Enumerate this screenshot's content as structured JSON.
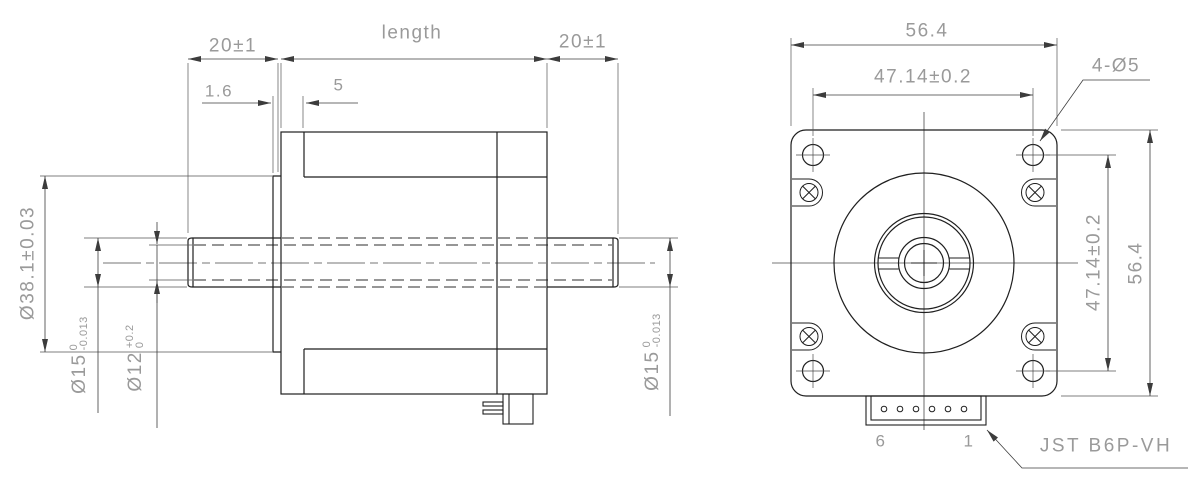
{
  "side_view": {
    "front_shaft_len": "20±1",
    "body_len": "length",
    "rear_shaft_len": "20±1",
    "boss_depth": "1.6",
    "front_section": "5",
    "boss_dia": "Ø38.1±0.03",
    "shaft_dia_left": {
      "main": "Ø15",
      "tol_top": "0",
      "tol_bot": "-0.013"
    },
    "bore_dia": {
      "main": "Ø12",
      "tol_top": "+0.2",
      "tol_bot": "0"
    },
    "shaft_dia_right": {
      "main": "Ø15",
      "tol_top": "0",
      "tol_bot": "-0.013"
    }
  },
  "front_view": {
    "width": "56.4",
    "bolt_spacing_top": "47.14±0.2",
    "mounting_holes": "4-Ø5",
    "bolt_spacing_side": "47.14±0.2",
    "height": "56.4",
    "connector": {
      "pin_left": "6",
      "pin_right": "1",
      "label": "JST B6P-VH"
    }
  },
  "style": {
    "object_line_color": "#1f1f1f",
    "dim_line_color": "#3c3c3c",
    "dim_text_color": "#9a9a9a",
    "background": "#ffffff"
  }
}
